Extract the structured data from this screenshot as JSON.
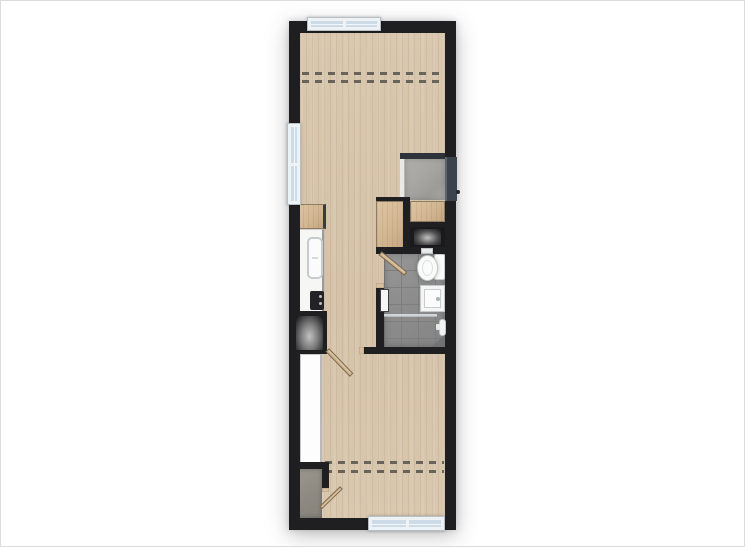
{
  "scene": {
    "type": "floor-plan",
    "description": "top-down rendered floor plan of a narrow studio apartment, no text labels",
    "canvas": {
      "width": 745,
      "height": 547
    }
  },
  "palette": {
    "canvas_bg": "#ffffff",
    "canvas_border": "#dcdcdc",
    "wall": "#1f1f21",
    "slate": "#2e333a",
    "door_slate": "#3b434e",
    "wood_floor": "#d9c7ae",
    "furniture_wood": "#d3b793",
    "wood_cap": "#d8c09e",
    "concrete_entry": "#a7a6a2",
    "concrete_closet": "#8f8b83",
    "tile": "#8d8d8d",
    "tile_grout": "#7e7e7e",
    "counter_white": "#f6f6f5",
    "fixture_white": "#fbfbfb",
    "window_frame": "#eef2f4",
    "window_glass": "#ccdbe6",
    "dash": "#55524c",
    "appliance_dark": "#1a1a1c",
    "appliance_glow": "#c2c2c2"
  },
  "rooms": [
    {
      "name": "living-area",
      "floor": "wood",
      "features": [
        "dashed-ceiling-break-lines",
        "top-window",
        "left-window"
      ]
    },
    {
      "name": "kitchen",
      "floor": "wood",
      "features": [
        "upper-cabinet",
        "counter",
        "sink",
        "cooktop",
        "refrigerator"
      ]
    },
    {
      "name": "entry",
      "floor": "concrete",
      "features": [
        "entry-door-right-wall",
        "side-panel"
      ]
    },
    {
      "name": "storage-zone",
      "features": [
        "tall-wardrobe",
        "shoe-cabinet",
        "washer-alcove"
      ]
    },
    {
      "name": "bathroom",
      "floor": "gray-tile",
      "features": [
        "toilet",
        "vanity-sink",
        "radiator",
        "shower-screen",
        "shower-control",
        "door-leaf"
      ]
    },
    {
      "name": "sleeping-area",
      "floor": "wood",
      "features": [
        "white-wardrobe",
        "corner-closet",
        "dashed-ceiling-break-lines",
        "bottom-window",
        "door-leaf"
      ]
    }
  ],
  "windows": [
    {
      "name": "top-window",
      "wall": "north",
      "panes": 2
    },
    {
      "name": "left-window",
      "wall": "west",
      "panes": 2
    },
    {
      "name": "bottom-window",
      "wall": "south",
      "panes": 2
    }
  ],
  "doors": [
    {
      "name": "entry-door",
      "wall": "east",
      "style": "dark-slab",
      "knob": true
    },
    {
      "name": "bathroom-door",
      "style": "swing-leaf"
    },
    {
      "name": "room-divider-door",
      "style": "swing-leaf"
    },
    {
      "name": "closet-door",
      "style": "swing-leaf"
    }
  ]
}
